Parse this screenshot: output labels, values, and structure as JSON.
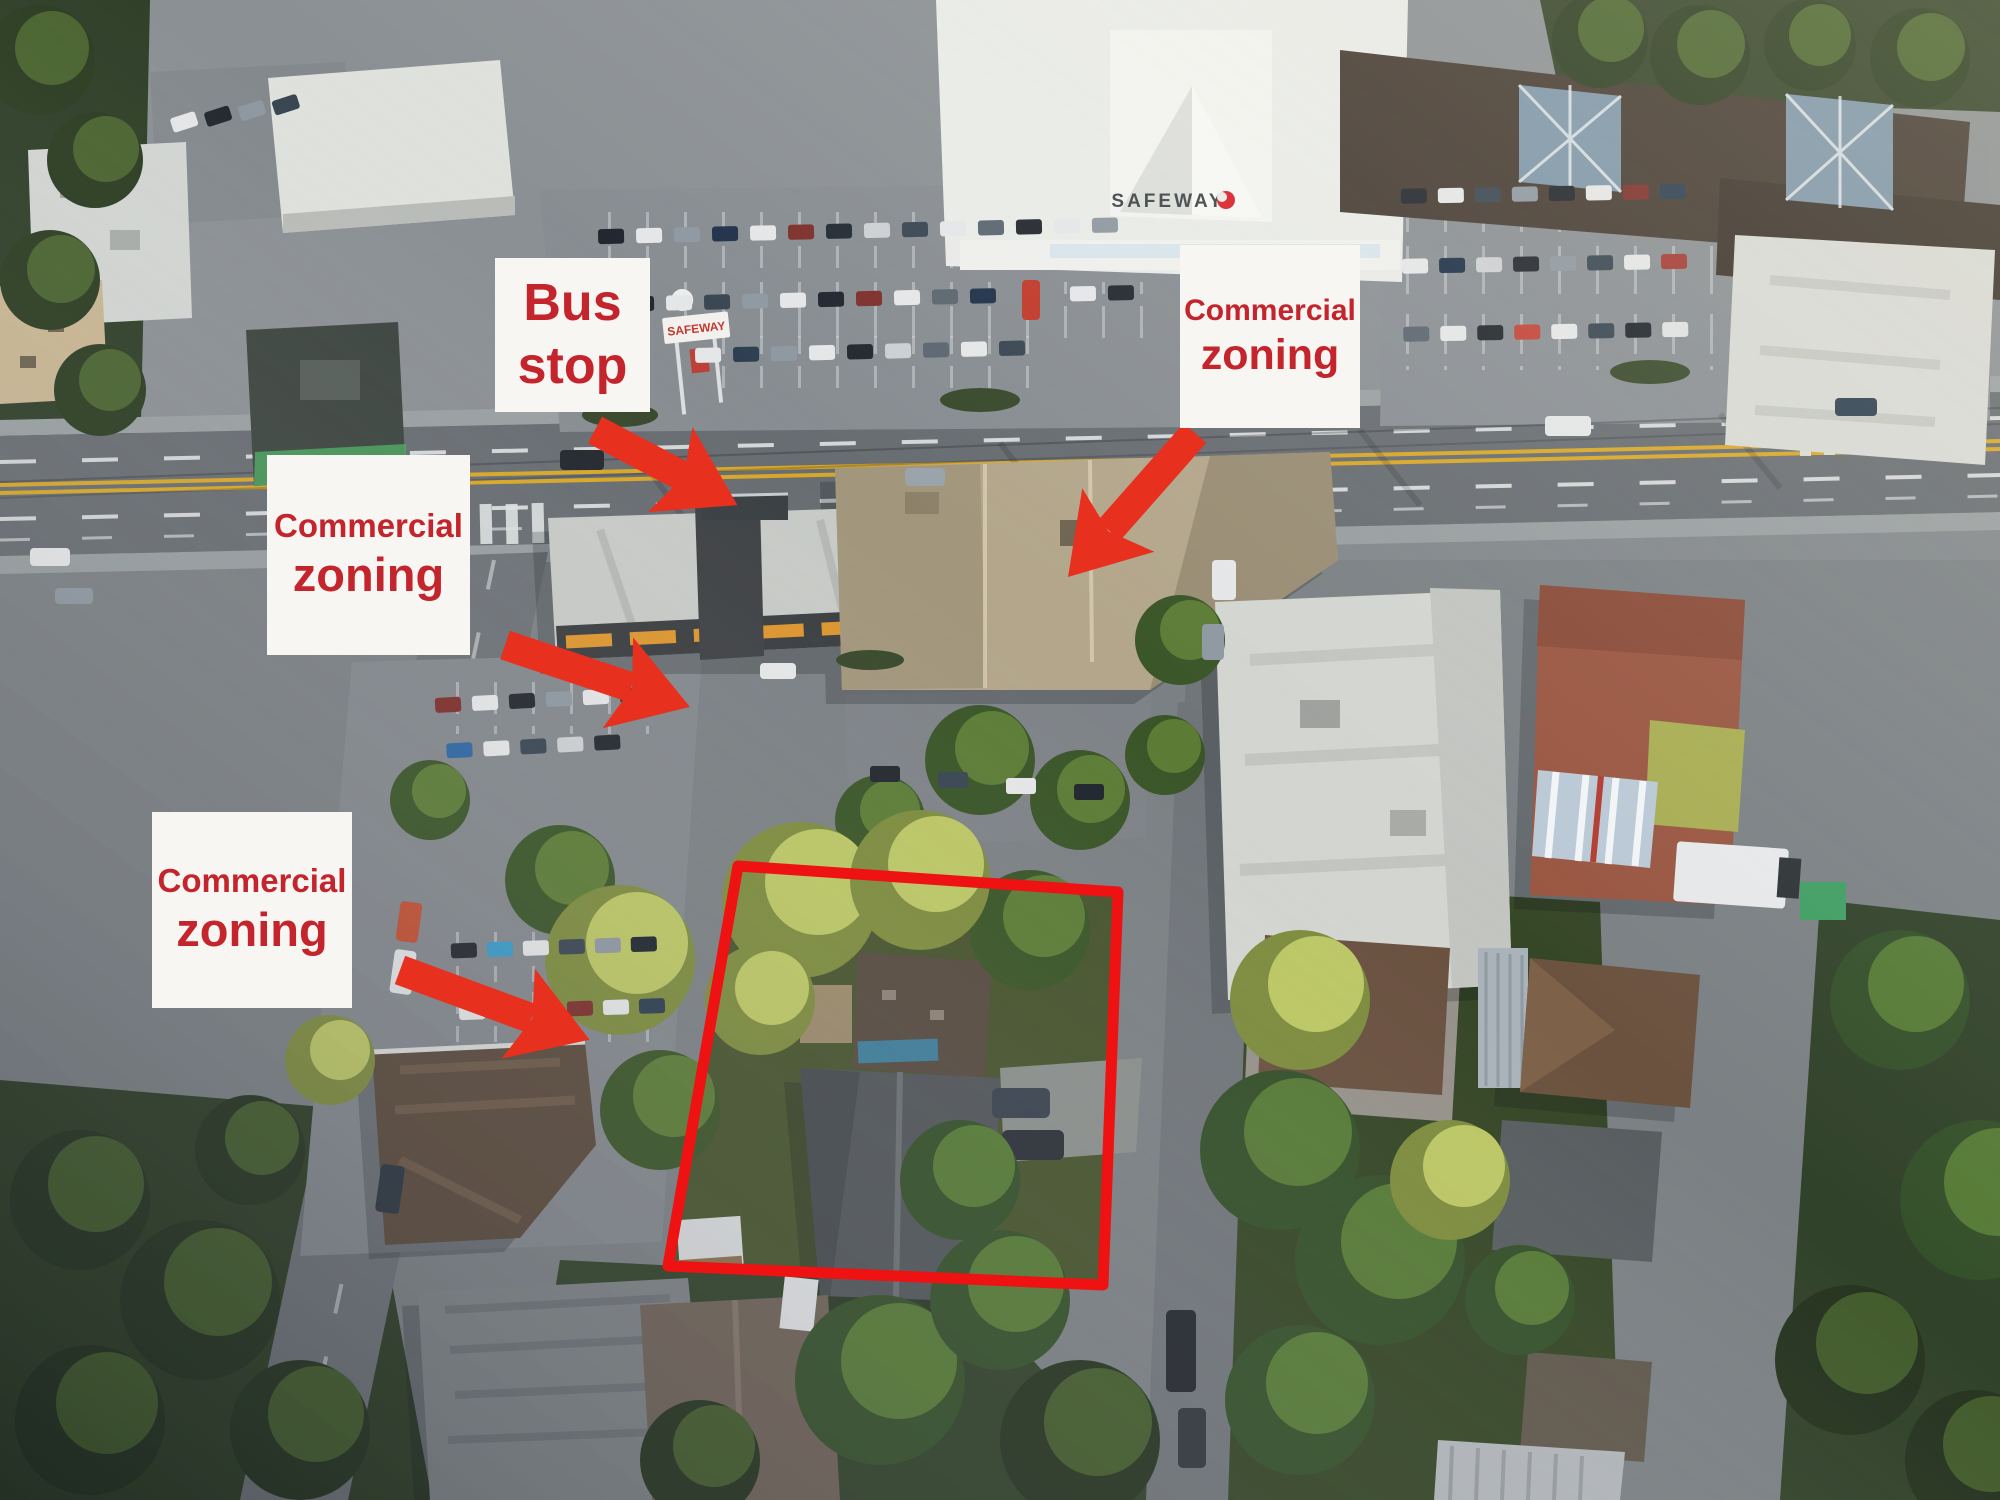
{
  "annotations": {
    "bus_stop": {
      "line1": "Bus",
      "line2": "stop"
    },
    "zoning_top_right": {
      "line1": "Commercial",
      "line2": "zoning"
    },
    "zoning_left": {
      "line1": "Commercial",
      "line2": "zoning"
    },
    "zoning_bottom_left": {
      "line1": "Commercial",
      "line2": "zoning"
    },
    "colors": {
      "label_background": "#f7f6f3",
      "label_text": "#c4242c",
      "arrow": "#e8301f",
      "property_outline": "#ee1212"
    }
  },
  "scene": {
    "safeway_building_sign": "SAFEWAY",
    "safeway_pole_sign": "SAFEWAY"
  }
}
